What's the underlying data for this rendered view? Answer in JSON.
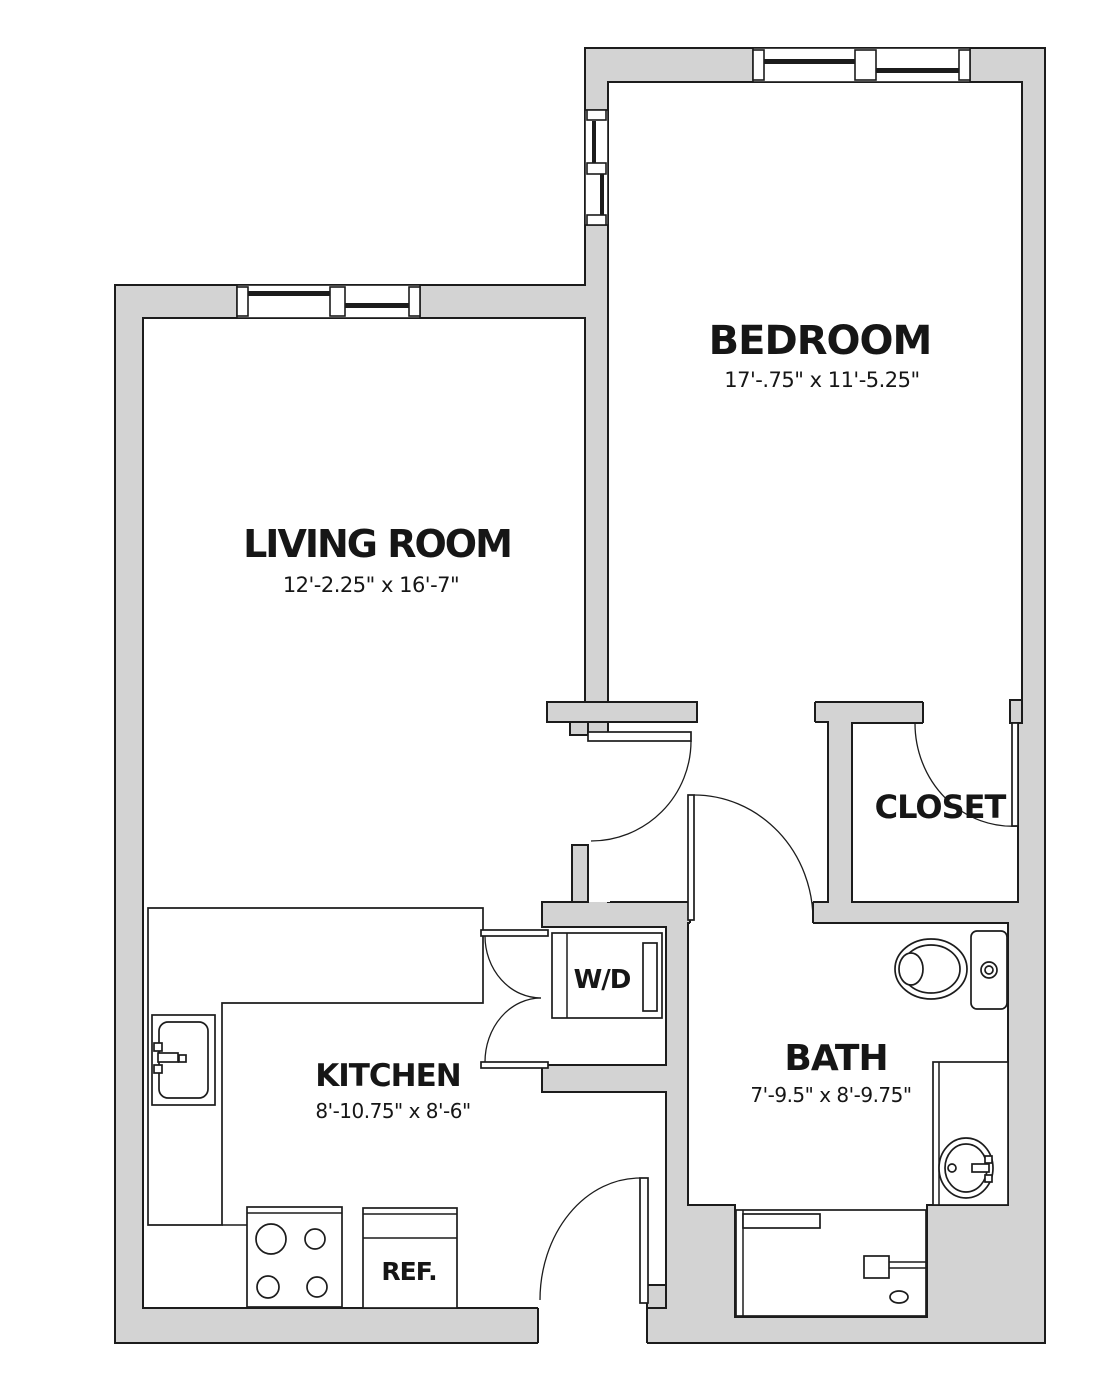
{
  "floorplan": {
    "title": "One-bedroom apartment floor plan",
    "rooms": [
      {
        "label": "BEDROOM",
        "dims": "17'-.75\" x 11'-5.25\""
      },
      {
        "label": "LIVING ROOM",
        "dims": "12'-2.25\" x 16'-7\""
      },
      {
        "label": "CLOSET",
        "dims": ""
      },
      {
        "label": "KITCHEN",
        "dims": "8'-10.75\" x 8'-6\""
      },
      {
        "label": "BATH",
        "dims": "7'-9.5\" x 8'-9.75\""
      }
    ],
    "fixtures": [
      {
        "label": "W/D"
      },
      {
        "label": "REF."
      }
    ],
    "colors": {
      "wall_fill": "#d3d3d3",
      "line": "#1c1c1c",
      "floor": "#ffffff"
    }
  }
}
